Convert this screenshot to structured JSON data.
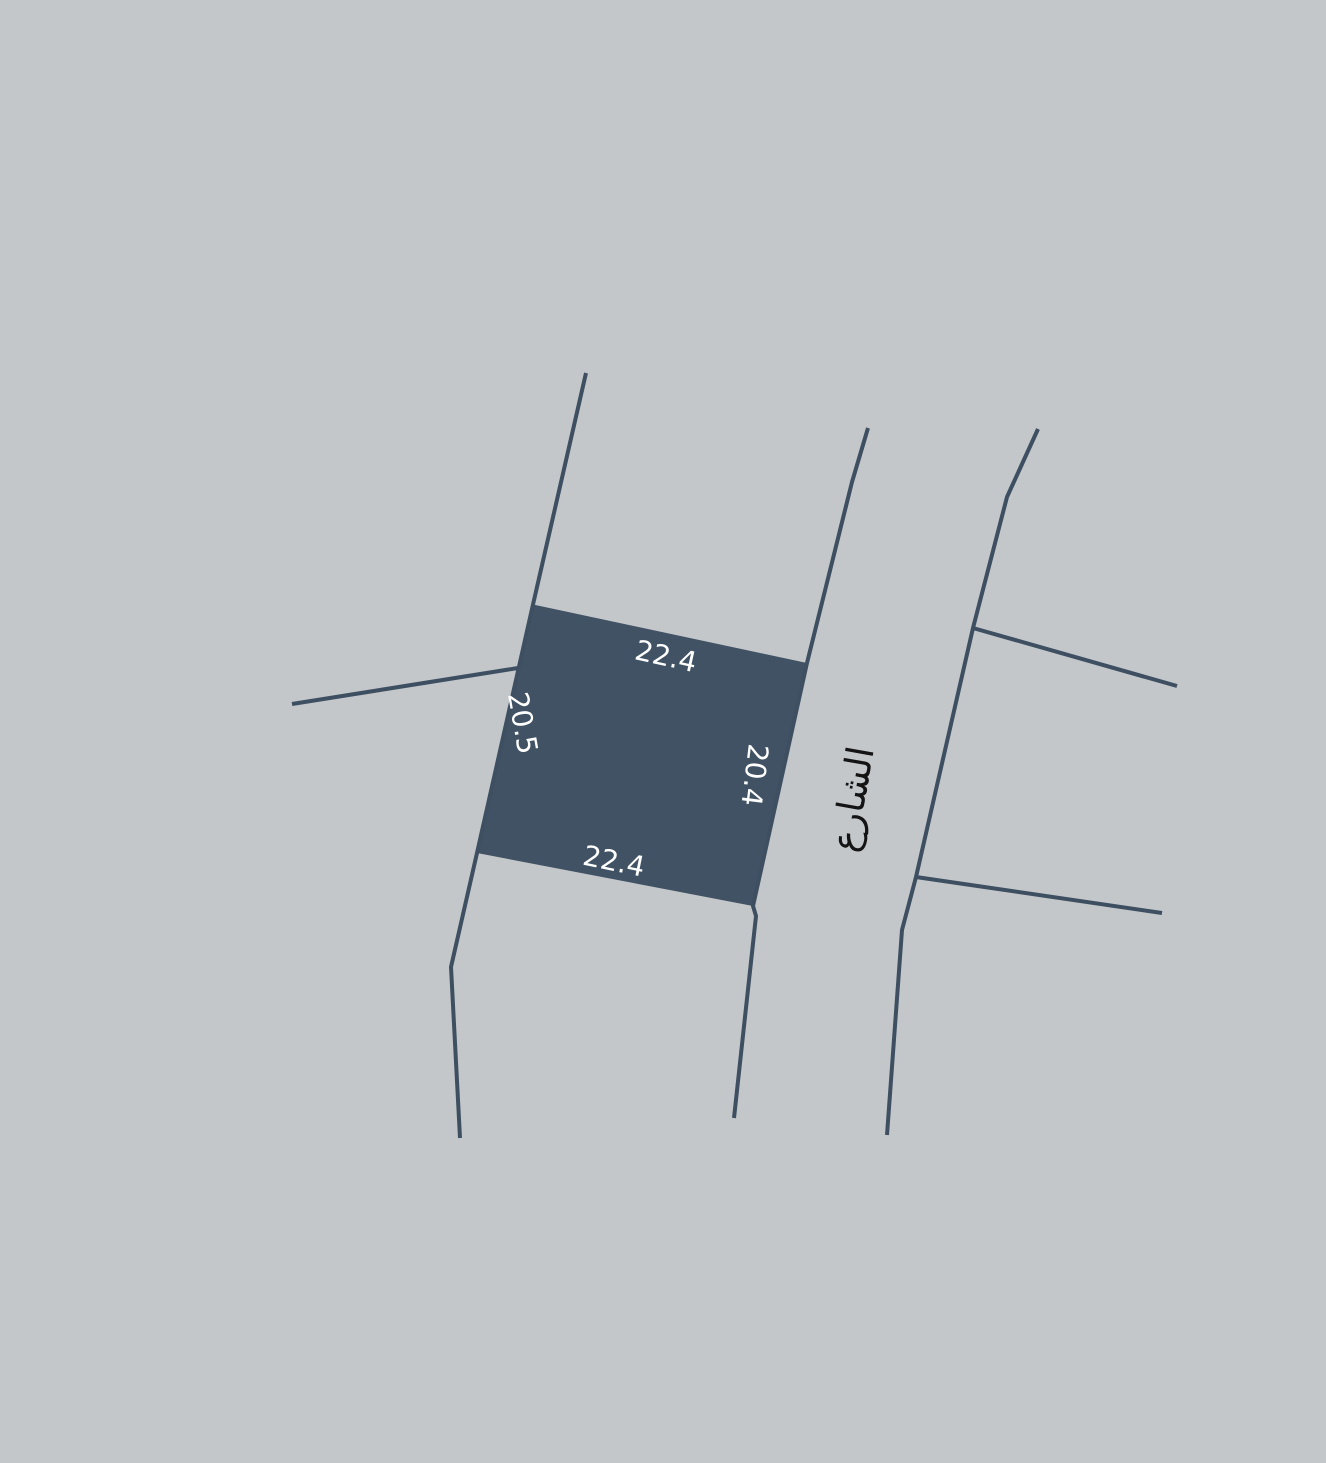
{
  "canvas": {
    "width": 1326,
    "height": 1463,
    "background": "#c3c7ca"
  },
  "colors": {
    "parcel_fill": "#405264",
    "boundary_line": "#3d4f61",
    "dimension_text": "#ffffff",
    "street_text": "#141414"
  },
  "parcel": {
    "dimensions": {
      "top": "22.4",
      "bottom": "22.4",
      "left": "20.5",
      "right": "20.4"
    }
  },
  "street": {
    "label": "الشارع"
  }
}
